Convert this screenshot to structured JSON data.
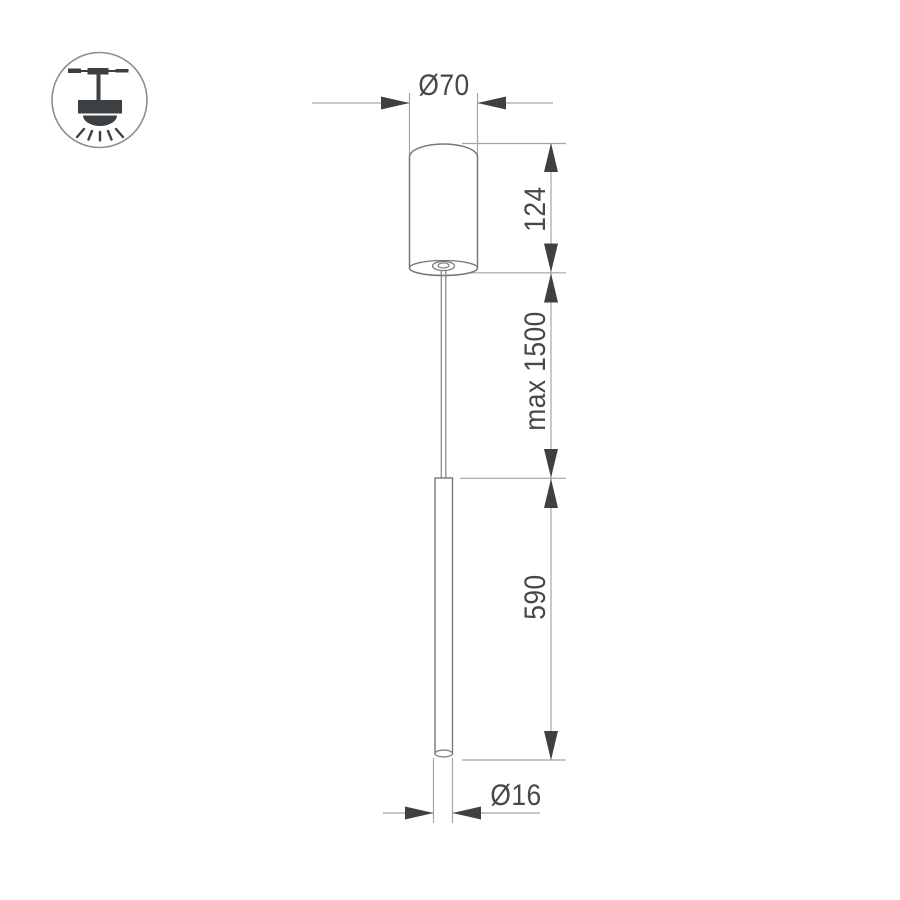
{
  "drawing": {
    "type": "pendant-lamp-dimension-drawing",
    "icon": "ceiling-pendant-light-icon",
    "labels": {
      "canopy_diameter": "Ø70",
      "canopy_height": "124",
      "suspension_length": "max 1500",
      "tube_length": "590",
      "tube_diameter": "Ø16"
    },
    "colors": {
      "background": "#ffffff",
      "object_outline": "#75787a",
      "dimension_line": "#a3a6a8",
      "arrow_and_text": "#3e4144",
      "icon_fill": "#3d4043",
      "icon_circle_outline": "#8b8e90"
    }
  }
}
